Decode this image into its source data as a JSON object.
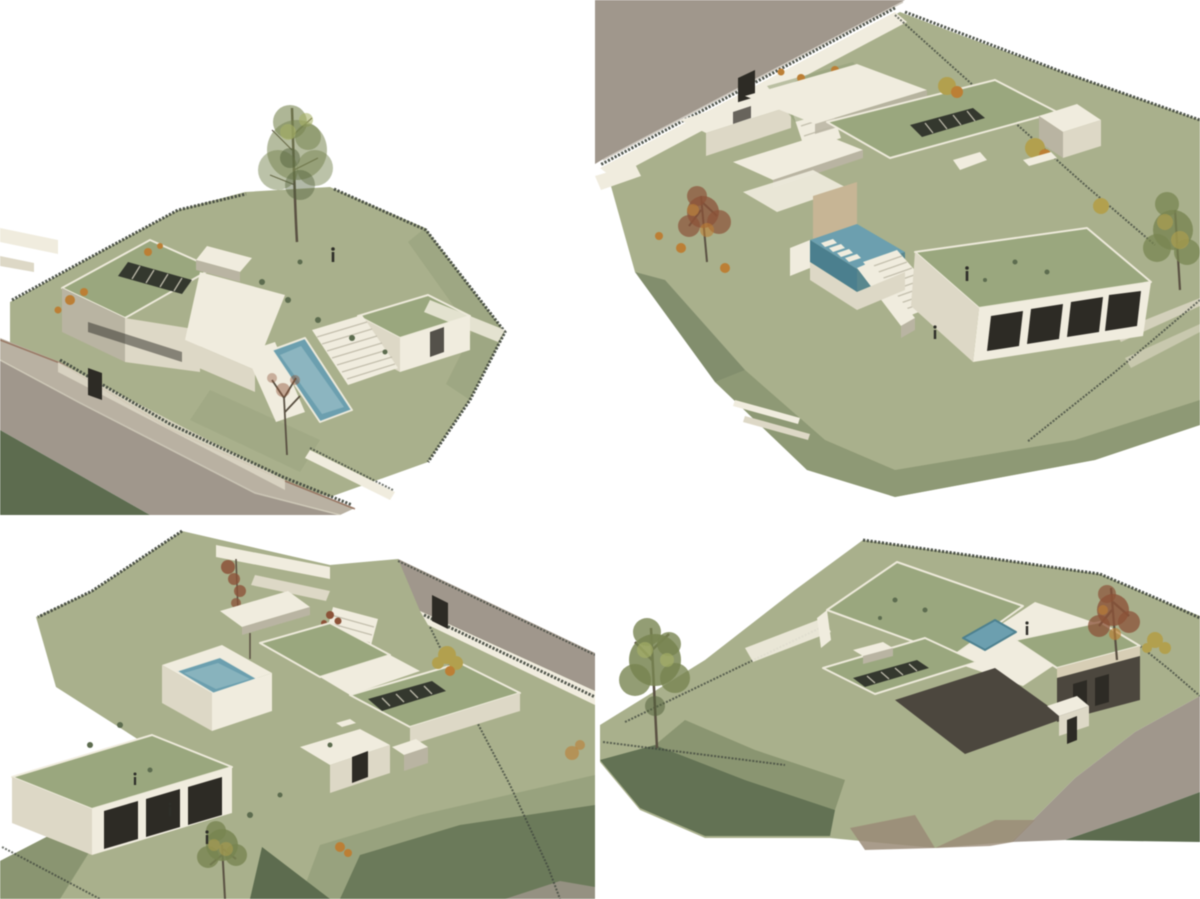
{
  "page": {
    "title": "Four axonometric 3D renderings of a hillside villa with planted roofs and pools",
    "background": "#ffffff"
  },
  "palette": {
    "bg": "#ffffff",
    "lawnLight": "#a9b08a",
    "lawnMid": "#96a17a",
    "slopeMid": "#7d8a64",
    "slopeDark": "#5c6c4e",
    "roofGreen": "#9aa77c",
    "skylight": "#34382e",
    "wallWhite": "#f0ecdd",
    "wallLight": "#ddd8c5",
    "wallMid": "#b9b4a1",
    "wallShade": "#8f8a79",
    "facadeDark": "#4c473e",
    "doorDark": "#2d2b25",
    "beige": "#d7ceb4",
    "tanWood": "#c8b593",
    "poolTeal": "#6aa0b0",
    "poolLight": "#a9cad1",
    "poolDark": "#49808f",
    "road": "#a0978b",
    "sidewalk": "#b9b1a1",
    "curbRed": "#8d5f49",
    "dirtBrown": "#9b8b76",
    "fence": "#3f463c",
    "fenceLight": "#97a294",
    "treeOlive": "#78854f",
    "treeDark": "#55643c",
    "treeLight": "#a8b264",
    "treeYellow": "#b3a04a",
    "autumnOrange": "#bf7f31",
    "autumnRed": "#8e5236",
    "trunk": "#5a5142",
    "figure": "#2e2e28"
  },
  "views": [
    {
      "id": "view-1",
      "position": "top-left",
      "description": "Axonometric view 1: villa with planted flat roofs, roof skylight strip, lap pool with garden stair, tall tree behind, fenced sloping plot, street at lower left"
    },
    {
      "id": "view-2",
      "position": "top-right",
      "description": "Axonometric view 2: entry court with planting beds, raised patio pool with loungers, stair cascade to the lawn, porch wing with four openings, street at upper left"
    },
    {
      "id": "view-3",
      "position": "bottom-left",
      "description": "Axonometric view 3: garden side with raised terrace pool, canopy roof, skylight strip, porch wing with three openings, young tree on the lower lawn, street at upper right"
    },
    {
      "id": "view-4",
      "position": "bottom-right",
      "description": "Axonometric view 4: rear view over the planted roofs with rooftop pool terrace, dark shaded facade, boundary fences with autumn tree, curving street at lower right"
    }
  ]
}
